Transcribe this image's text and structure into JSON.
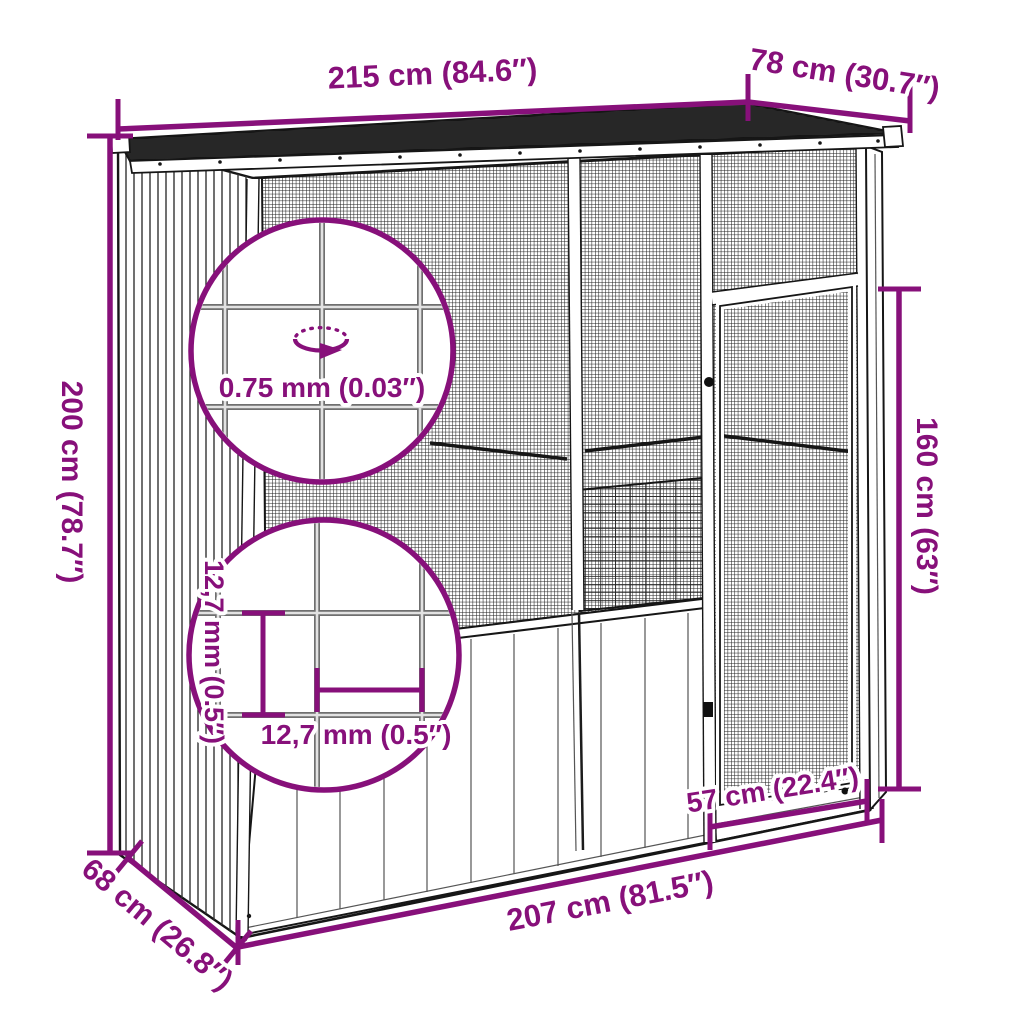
{
  "diagram": {
    "accent_color": "#87107A",
    "line_color": "#161616",
    "dimensions": {
      "top_width": "215 cm (84.6″)",
      "top_depth": "78 cm (30.7″)",
      "left_height": "200 cm (78.7″)",
      "door_height": "160 cm (63″)",
      "door_width": "57 cm (22.4″)",
      "bottom_width": "207 cm (81.5″)",
      "bottom_depth": "68 cm (26.8″)"
    },
    "callouts": {
      "wire_thickness": "0.75 mm (0.03″)",
      "mesh_pitch_vertical": "12,7 mm (0.5″)",
      "mesh_pitch_horizontal": "12,7 mm (0.5″)"
    }
  }
}
